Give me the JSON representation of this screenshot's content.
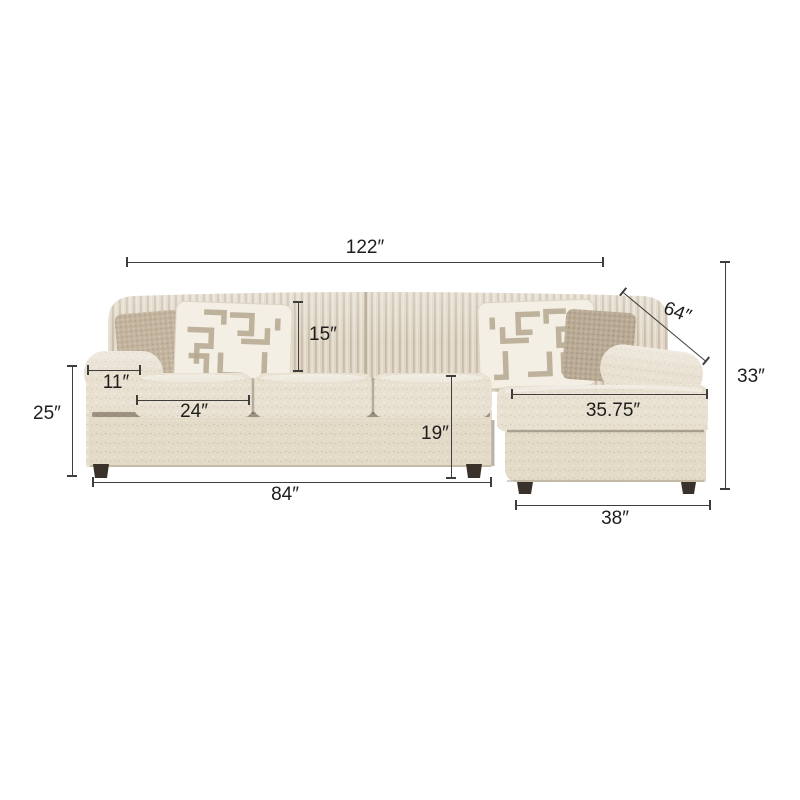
{
  "colors": {
    "background": "#ffffff",
    "dim_line": "#3f3e3d",
    "dim_text": "#1f1d1b",
    "fabric": "#e8e0d1",
    "fabric_mid": "#e3dac8",
    "fabric_shadow": "#cec2ad",
    "back_cushion": "#ded5c6",
    "rib_shadow": "#c9bda9",
    "pillow_cream": "#f3efe5",
    "pillow_pattern": "#b5a78f",
    "pillow_taupe": "#c2b49e",
    "pillow_taupe_dark": "#b8aa94",
    "feet": "#3a322a",
    "seam": "#5c4c3b"
  },
  "dimensions": {
    "overall_width": {
      "label": "122″"
    },
    "chaise_diagonal": {
      "label": "64″"
    },
    "overall_height": {
      "label": "33″"
    },
    "back_cushion_height": {
      "label": "15″"
    },
    "arm_width": {
      "label": "11″"
    },
    "seat_cushion_width": {
      "label": "24″"
    },
    "arm_height": {
      "label": "25″"
    },
    "seat_height": {
      "label": "19″"
    },
    "sofa_section_width": {
      "label": "84″"
    },
    "chaise_cushion_width": {
      "label": "35.75″"
    },
    "chaise_base_width": {
      "label": "38″"
    }
  }
}
